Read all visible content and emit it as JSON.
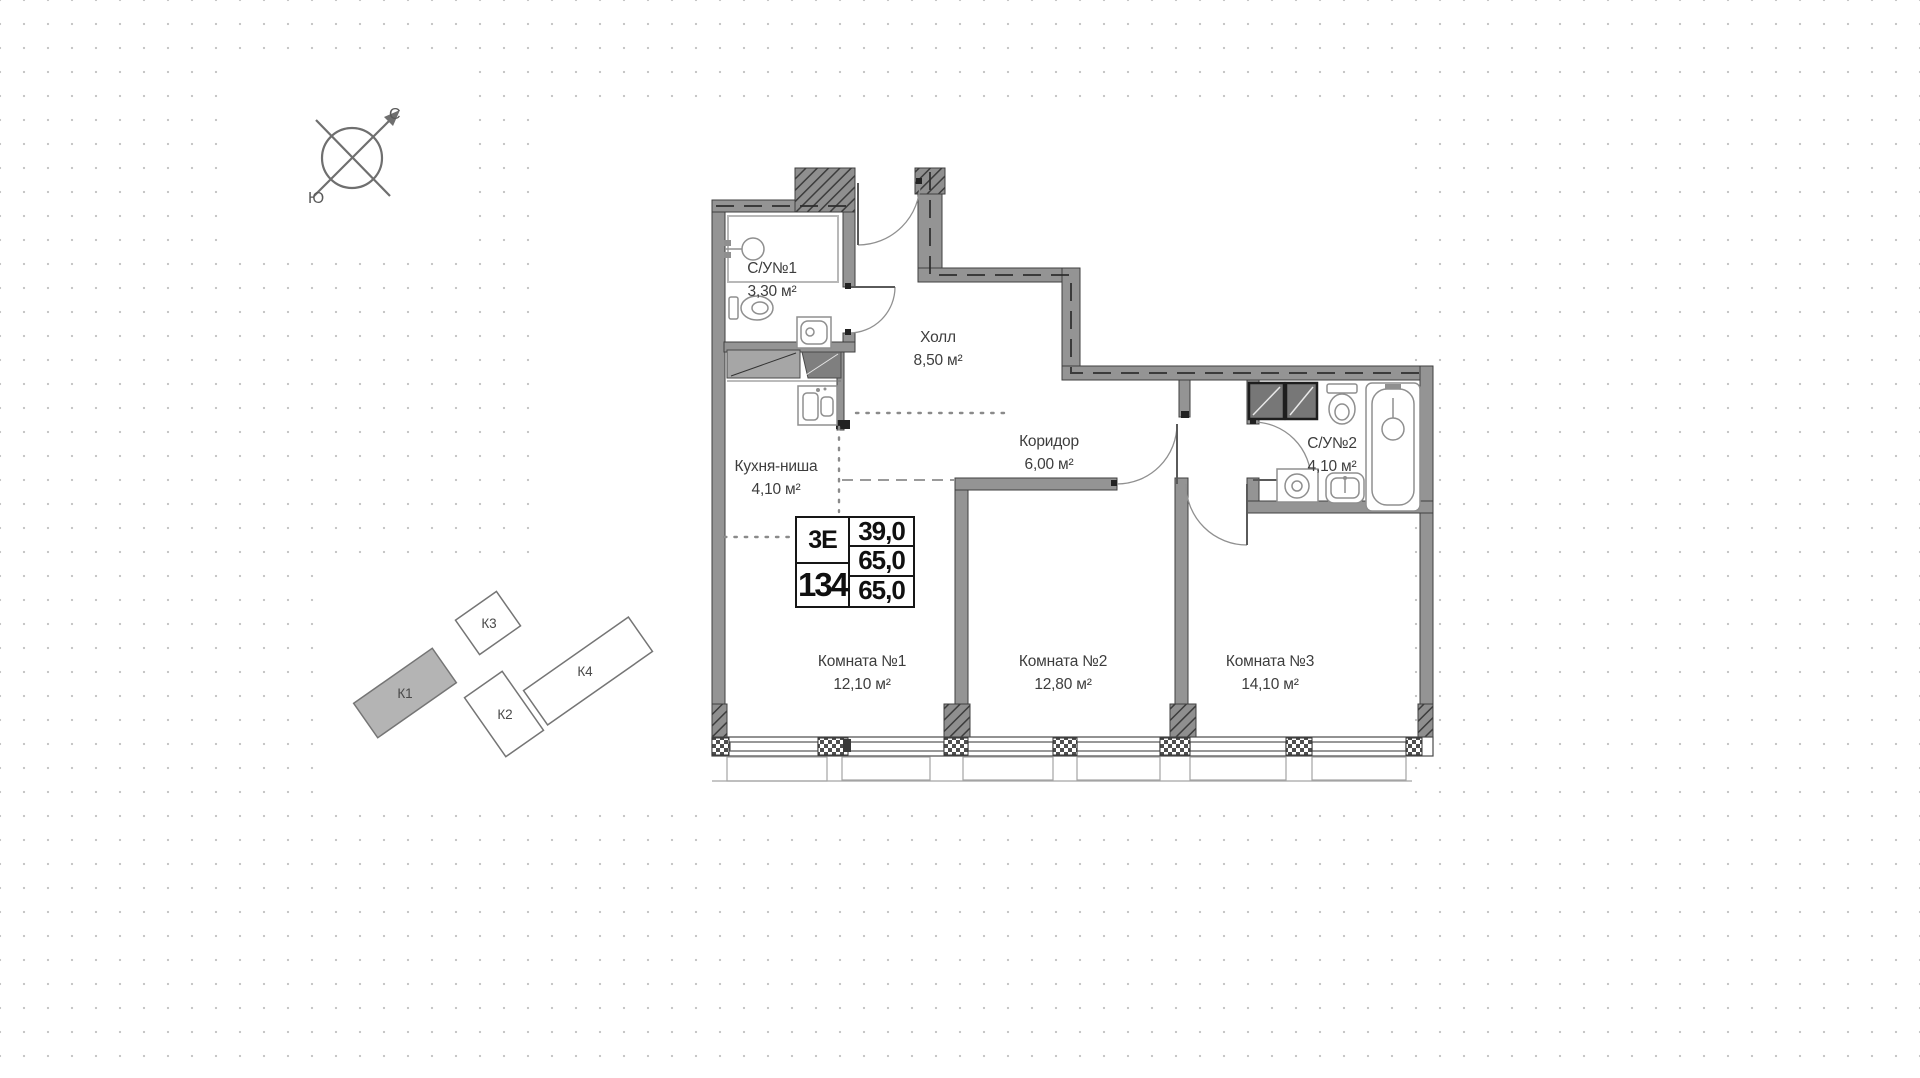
{
  "compass": {
    "north": "С",
    "south": "Ю"
  },
  "site_map": {
    "buildings": [
      {
        "label": "К1",
        "highlighted": true
      },
      {
        "label": "К2",
        "highlighted": false
      },
      {
        "label": "К3",
        "highlighted": false
      },
      {
        "label": "К4",
        "highlighted": false
      }
    ]
  },
  "floor_plan": {
    "rooms": [
      {
        "name": "С/У№1",
        "area": "3,30 м²"
      },
      {
        "name": "Холл",
        "area": "8,50 м²"
      },
      {
        "name": "Кухня-ниша",
        "area": "4,10 м²"
      },
      {
        "name": "Коридор",
        "area": "6,00 м²"
      },
      {
        "name": "С/У№2",
        "area": "4,10 м²"
      },
      {
        "name": "Комната №1",
        "area": "12,10 м²"
      },
      {
        "name": "Комната №2",
        "area": "12,80 м²"
      },
      {
        "name": "Комната №3",
        "area": "14,10 м²"
      }
    ],
    "info_table": {
      "layout_type": "3Е",
      "apartment_number": "134",
      "value_top": "39,0",
      "value_mid": "65,0",
      "value_bottom": "65,0"
    }
  },
  "colors": {
    "wall": "#949494",
    "building_highlight": "#b4b4b4",
    "dots": "#c7c7c7"
  }
}
